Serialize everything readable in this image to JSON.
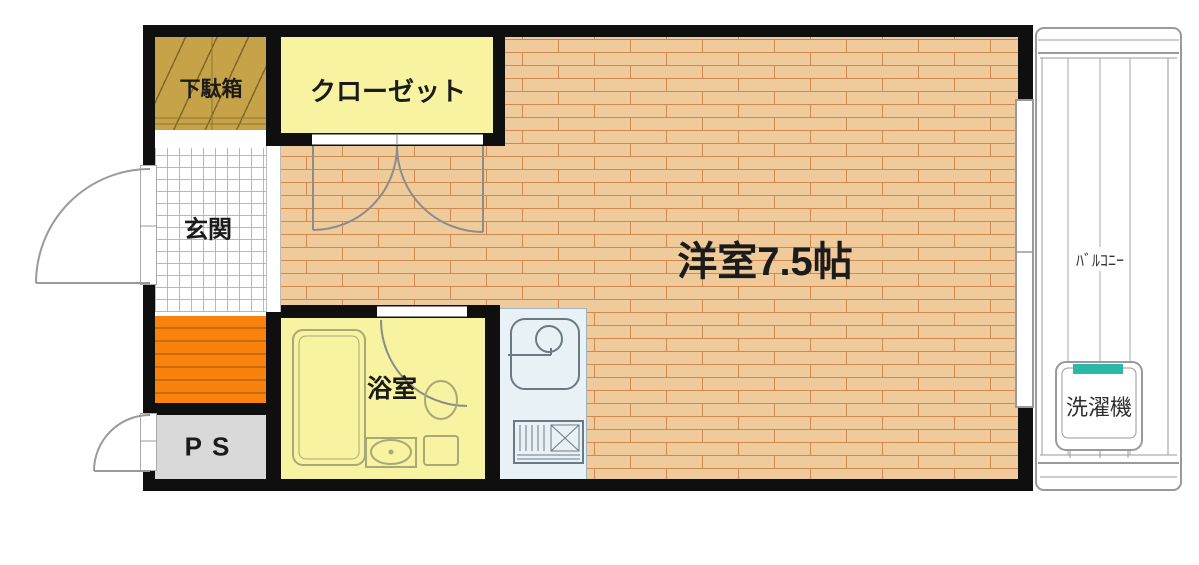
{
  "floorplan": {
    "type": "japanese-apartment-floor-plan",
    "rooms": {
      "shoe_cabinet": {
        "label": "下駄箱"
      },
      "closet": {
        "label": "クローゼット"
      },
      "entrance": {
        "label": "玄関"
      },
      "western_room": {
        "label": "洋室7.5帖",
        "size_tatami": 7.5
      },
      "bathroom": {
        "label": "浴室"
      },
      "pipe_space": {
        "label": "PS"
      },
      "balcony": {
        "label": "ﾊﾞﾙｺﾆｰ"
      },
      "washing_machine": {
        "label": "洗濯機"
      }
    },
    "colors": {
      "wall": "#0f0f0f",
      "wood_floor": "#efcb9c",
      "wood_line": "#d0894f",
      "room_yellow": "#f7f3a0",
      "cabinet_gold": "#c6a348",
      "tile_line": "#ea9e74",
      "orange_zone": "#f8820c",
      "pipe_space_gray": "#d9d9d9",
      "kitchen_blue": "#e8f1f5",
      "washer_teal": "#2cb8a6",
      "outline_gray": "#9a9a9a"
    }
  }
}
